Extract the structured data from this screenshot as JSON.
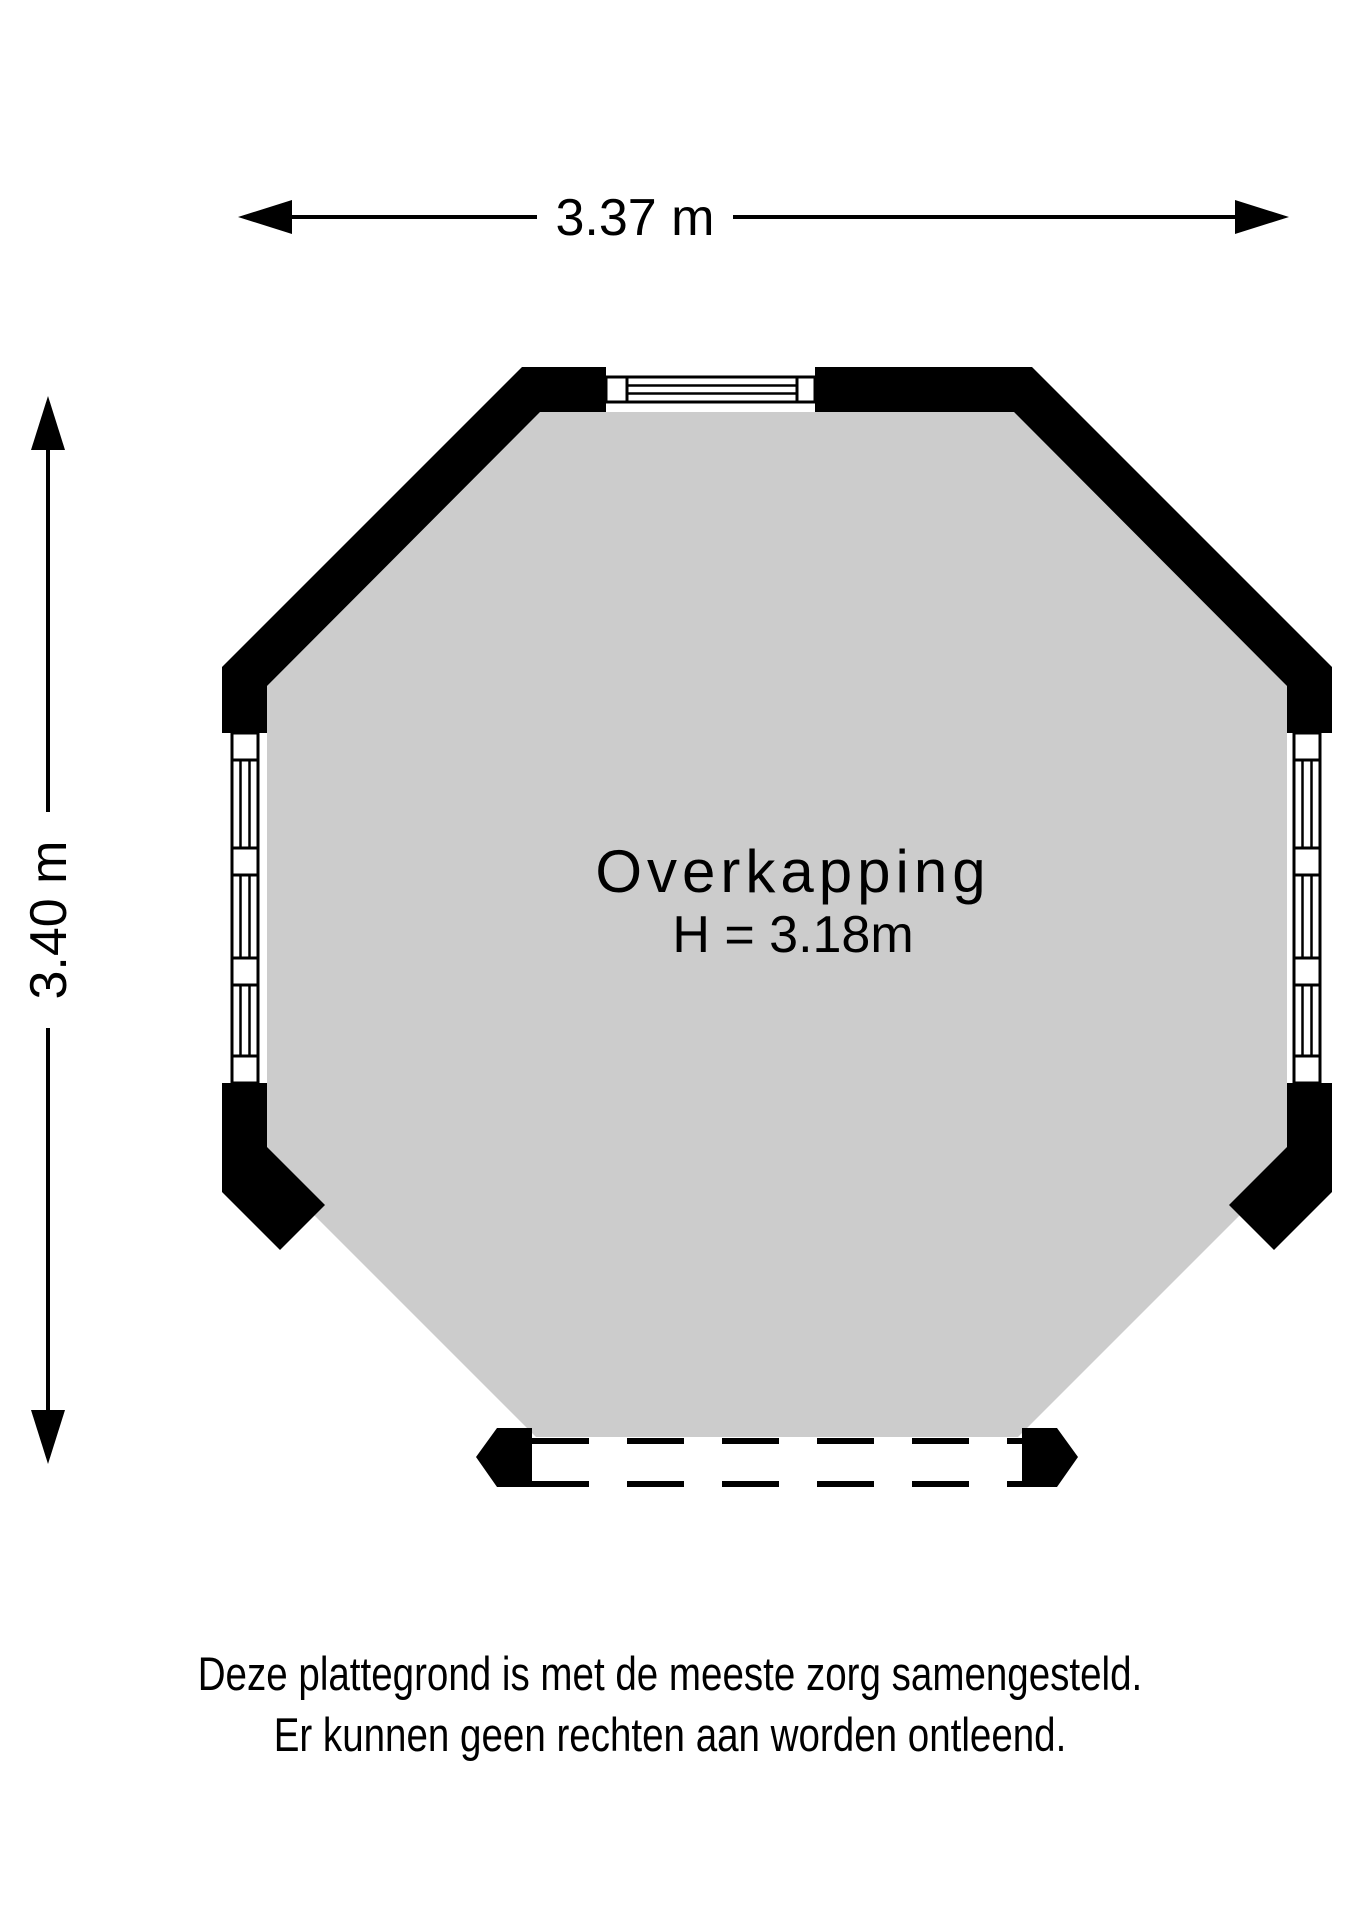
{
  "floor_plan": {
    "room": {
      "name": "Overkapping",
      "height_label": "H = 3.18m"
    },
    "dimensions": {
      "width_label": "3.37 m",
      "height_label": "3.40 m"
    },
    "disclaimer": {
      "line1": "Deze plattegrond is met de meeste zorg samengesteld.",
      "line2": "Er kunnen geen rechten aan worden ontleend."
    },
    "colors": {
      "floor": "#cccccc",
      "wall": "#000000",
      "text": "#000000",
      "background": "#ffffff"
    }
  }
}
